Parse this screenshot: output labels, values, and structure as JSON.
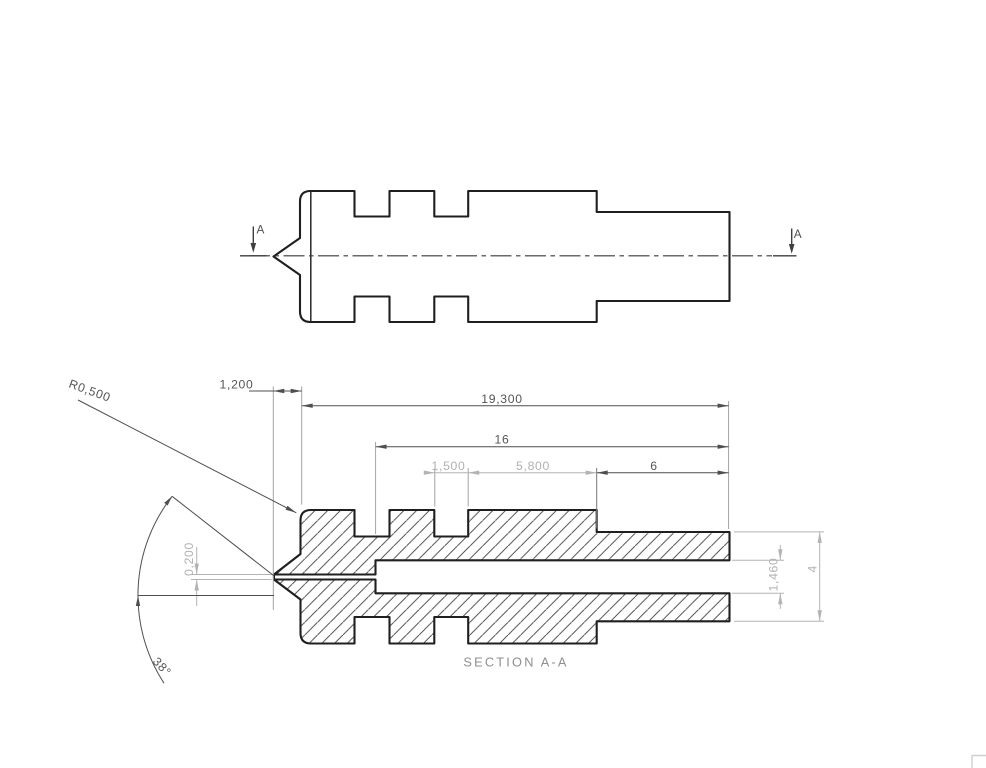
{
  "drawing": {
    "section_label": "SECTION A-A",
    "cut_label": "A",
    "dims": {
      "tip_radius": "R0,500",
      "tip_length": "1,200",
      "overall_length": "19,300",
      "bore_depth": "16",
      "groove_width": "1,500",
      "mid_length": "5,800",
      "shank_length": "6",
      "orifice_dia": "0,200",
      "bore_dia": "1,460",
      "shank_dia": "4",
      "cone_angle": "38°"
    },
    "colors": {
      "outline": "#1f1f1f",
      "dim_dark": "#4f4f4f",
      "dim_gray": "#b0b0b0",
      "hatch": "#3d3d3d",
      "section_label_gray": "#8f8f8f",
      "sheet_corner": "#cfcfcf",
      "background": "#ffffff"
    }
  }
}
